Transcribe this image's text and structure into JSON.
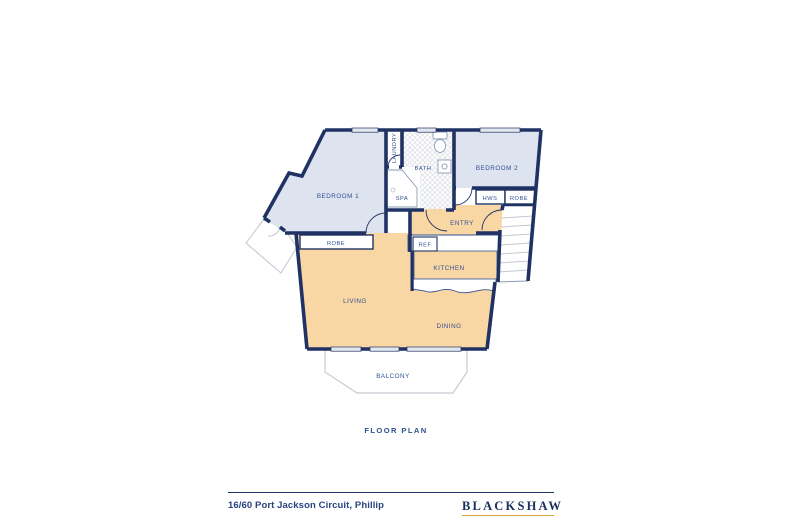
{
  "title": "FLOOR PLAN",
  "rooms": {
    "bedroom1": "BEDROOM 1",
    "bedroom2": "BEDROOM 2",
    "laundry": "LAUNDRY",
    "bath": "BATH",
    "spa": "SPA",
    "hws": "HWS",
    "robe_hall": "ROBE",
    "robe_bed1": "ROBE",
    "entry": "ENTRY",
    "ref": "REF",
    "kitchen": "KITCHEN",
    "living": "LIVING",
    "dining": "DINING",
    "balcony": "BALCONY"
  },
  "footer": {
    "address": "16/60 Port Jackson Circuit, Phillip",
    "brand": "BLACKSHAW"
  },
  "colors": {
    "wall_navy": "#1f3263",
    "bedroom_fill": "#dde3ef",
    "living_fill": "#f9d7a5",
    "label_navy": "#30508f",
    "light_outline": "#c6cbd4",
    "window_fill": "#e4e7ed",
    "brand_navy": "#1b3060",
    "brand_gold": "#d8a93a"
  }
}
